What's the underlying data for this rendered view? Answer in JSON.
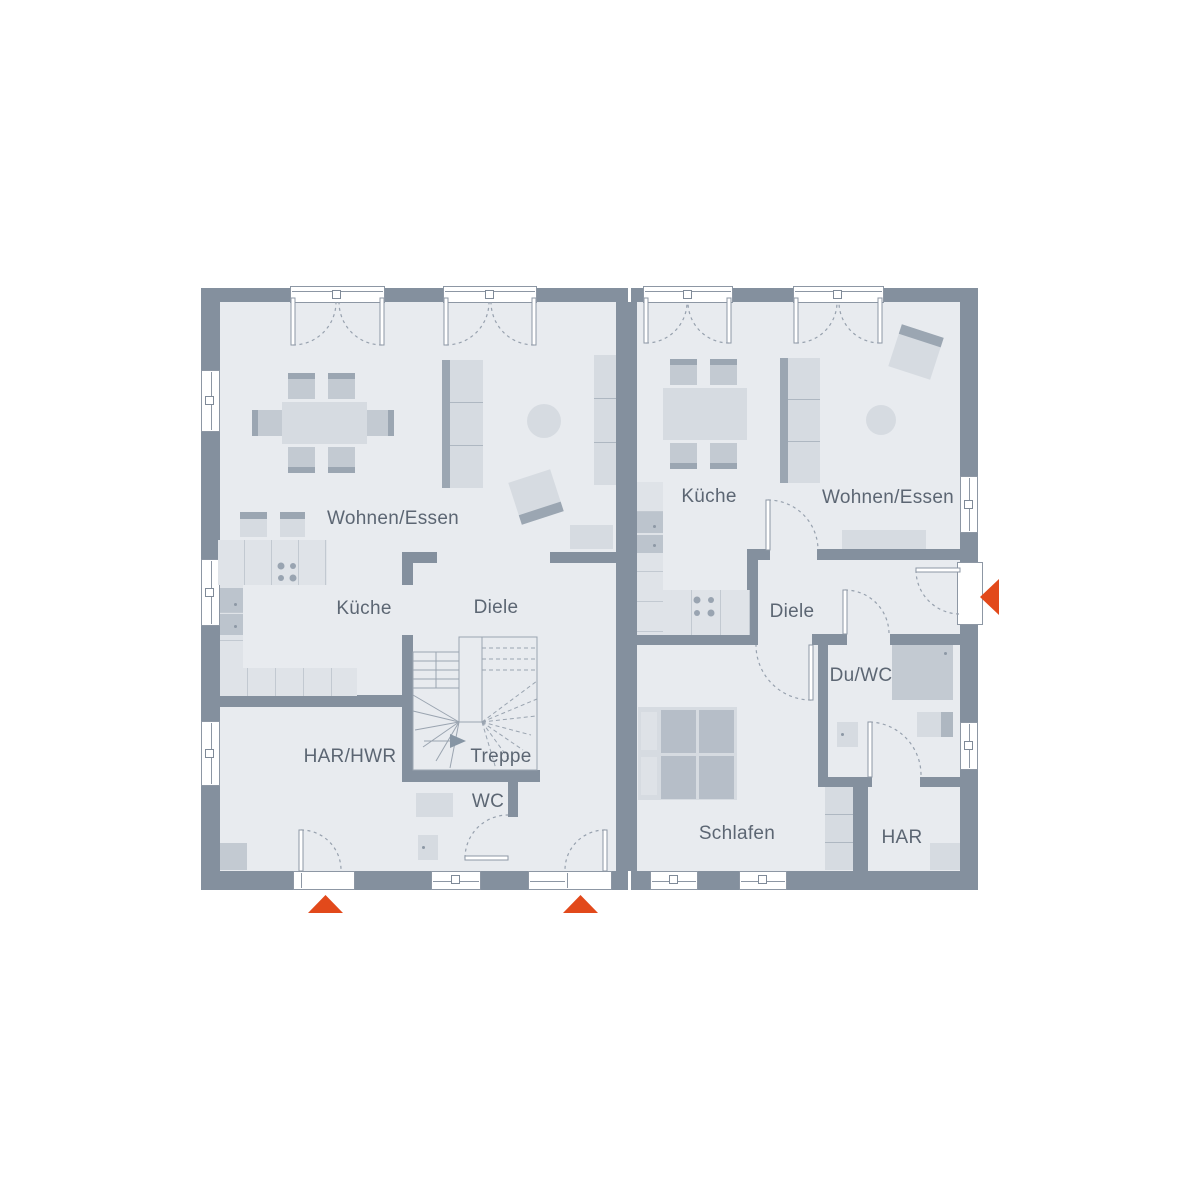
{
  "colors": {
    "accent": "#e2491b",
    "wall": "#84909e",
    "floor": "#e8ebef",
    "label": "#5c6673",
    "furniture_light": "#d6dbe1",
    "furniture_mid": "#c3cad2",
    "furniture_dark": "#9ba6b2",
    "counter": "#dfe3e8"
  },
  "plan": {
    "left_unit": {
      "rooms": {
        "wohnen_essen": "Wohnen/Essen",
        "kueche": "Küche",
        "diele": "Diele",
        "har_hwr": "HAR/HWR",
        "treppe": "Treppe",
        "wc": "WC"
      }
    },
    "right_unit": {
      "rooms": {
        "kueche": "Küche",
        "wohnen_essen": "Wohnen/Essen",
        "diele": "Diele",
        "du_wc": "Du/WC",
        "schlafen": "Schlafen",
        "har": "HAR"
      }
    },
    "entrance_markers": [
      {
        "direction": "up"
      },
      {
        "direction": "up"
      },
      {
        "direction": "left"
      }
    ]
  }
}
